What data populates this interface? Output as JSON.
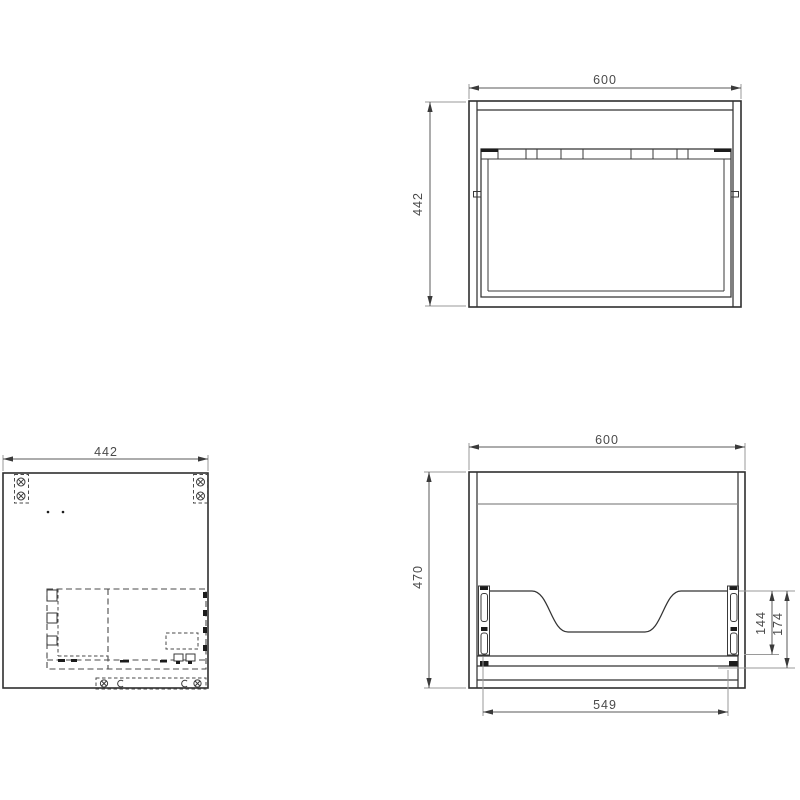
{
  "drawing": {
    "background_color": "#ffffff",
    "object_line_color": "#2f2f2f",
    "dimension_text_color": "#4a4a4a",
    "views": {
      "top_view": {
        "width_label": "600",
        "depth_label": "442"
      },
      "side_view": {
        "depth_label": "442"
      },
      "front_view": {
        "width_label": "600",
        "height_label": "470",
        "drawer_width_label": "549",
        "rail_length_label": "144",
        "rail_offset_label": "174"
      }
    }
  }
}
